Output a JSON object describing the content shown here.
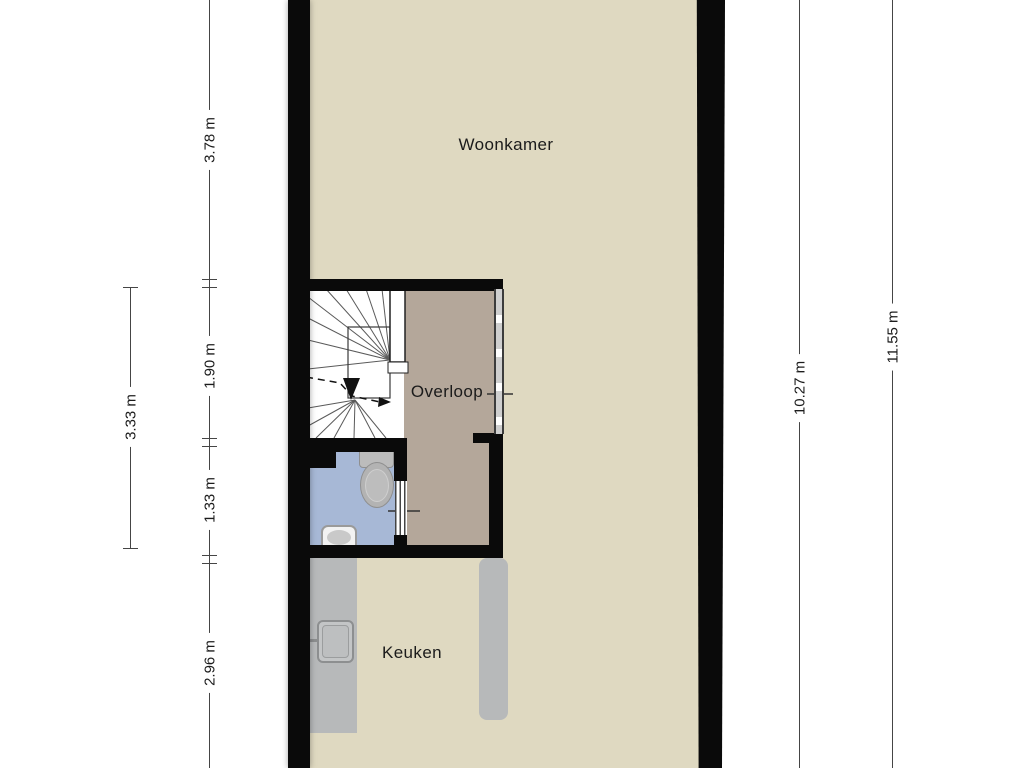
{
  "floorplan": {
    "rooms": {
      "woonkamer": "Woonkamer",
      "overloop": "Overloop",
      "keuken": "Keuken"
    },
    "dimensions": {
      "left_segments": [
        "3.78 m",
        "1.90 m",
        "1.33 m",
        "2.96 m"
      ],
      "left_outer": "3.33 m",
      "right_inner": "10.27 m",
      "right_outer": "11.55 m"
    },
    "colors": {
      "floor": "#dfd9c1",
      "hall_floor": "#b4a79a",
      "wc_floor": "#a7b8d6",
      "counter": "#b7b9ba",
      "wall": "#0a0a0a",
      "background": "#ffffff"
    }
  }
}
